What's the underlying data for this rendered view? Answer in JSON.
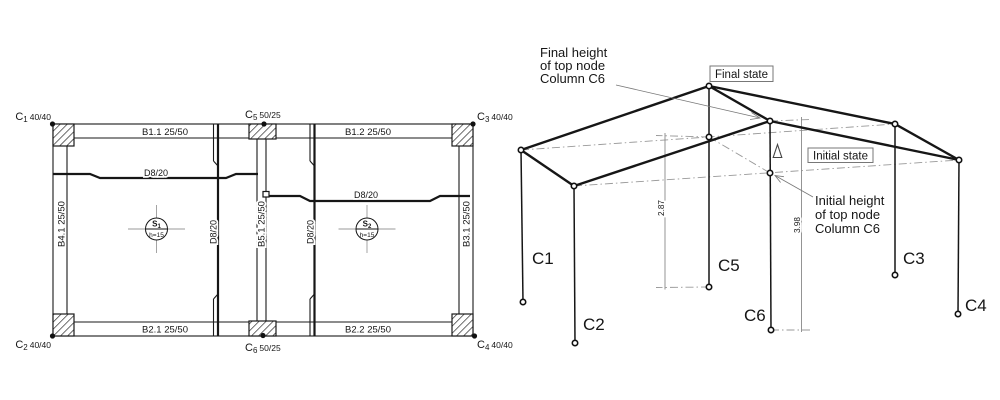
{
  "plan": {
    "columns": [
      {
        "id": "C",
        "sub": "1",
        "size": "40/40"
      },
      {
        "id": "C",
        "sub": "2",
        "size": "40/40"
      },
      {
        "id": "C",
        "sub": "3",
        "size": "40/40"
      },
      {
        "id": "C",
        "sub": "4",
        "size": "40/40"
      },
      {
        "id": "C",
        "sub": "5",
        "size": "50/25"
      },
      {
        "id": "C",
        "sub": "6",
        "size": "50/25"
      }
    ],
    "beams": [
      {
        "label": "B1.1 25/50"
      },
      {
        "label": "B1.2 25/50"
      },
      {
        "label": "B2.1 25/50"
      },
      {
        "label": "B2.2 25/50"
      },
      {
        "label": "B4.1 25/50"
      },
      {
        "label": "B5.1 25/50"
      },
      {
        "label": "B3.1 25/50"
      }
    ],
    "rebar": {
      "h_left": "D8/20",
      "h_right": "D8/20",
      "v_left": "D8/20",
      "v_right": "D8/20"
    },
    "slabs": [
      {
        "id": "S",
        "sub": "1",
        "thickness": "h=15"
      },
      {
        "id": "S",
        "sub": "2",
        "thickness": "h=15"
      }
    ]
  },
  "deformation": {
    "columns": {
      "c1": "C1",
      "c2": "C2",
      "c3": "C3",
      "c4": "C4",
      "c5": "C5",
      "c6": "C6"
    },
    "state_final": "Final state",
    "state_initial": "Initial state",
    "note_final": {
      "l1": "Final height",
      "l2": "of top node",
      "l3": "Column C6"
    },
    "note_initial": {
      "l1": "Initial height",
      "l2": "of top node",
      "l3": "Column C6"
    },
    "dim_initial": "2.87",
    "dim_final": "3.98"
  }
}
